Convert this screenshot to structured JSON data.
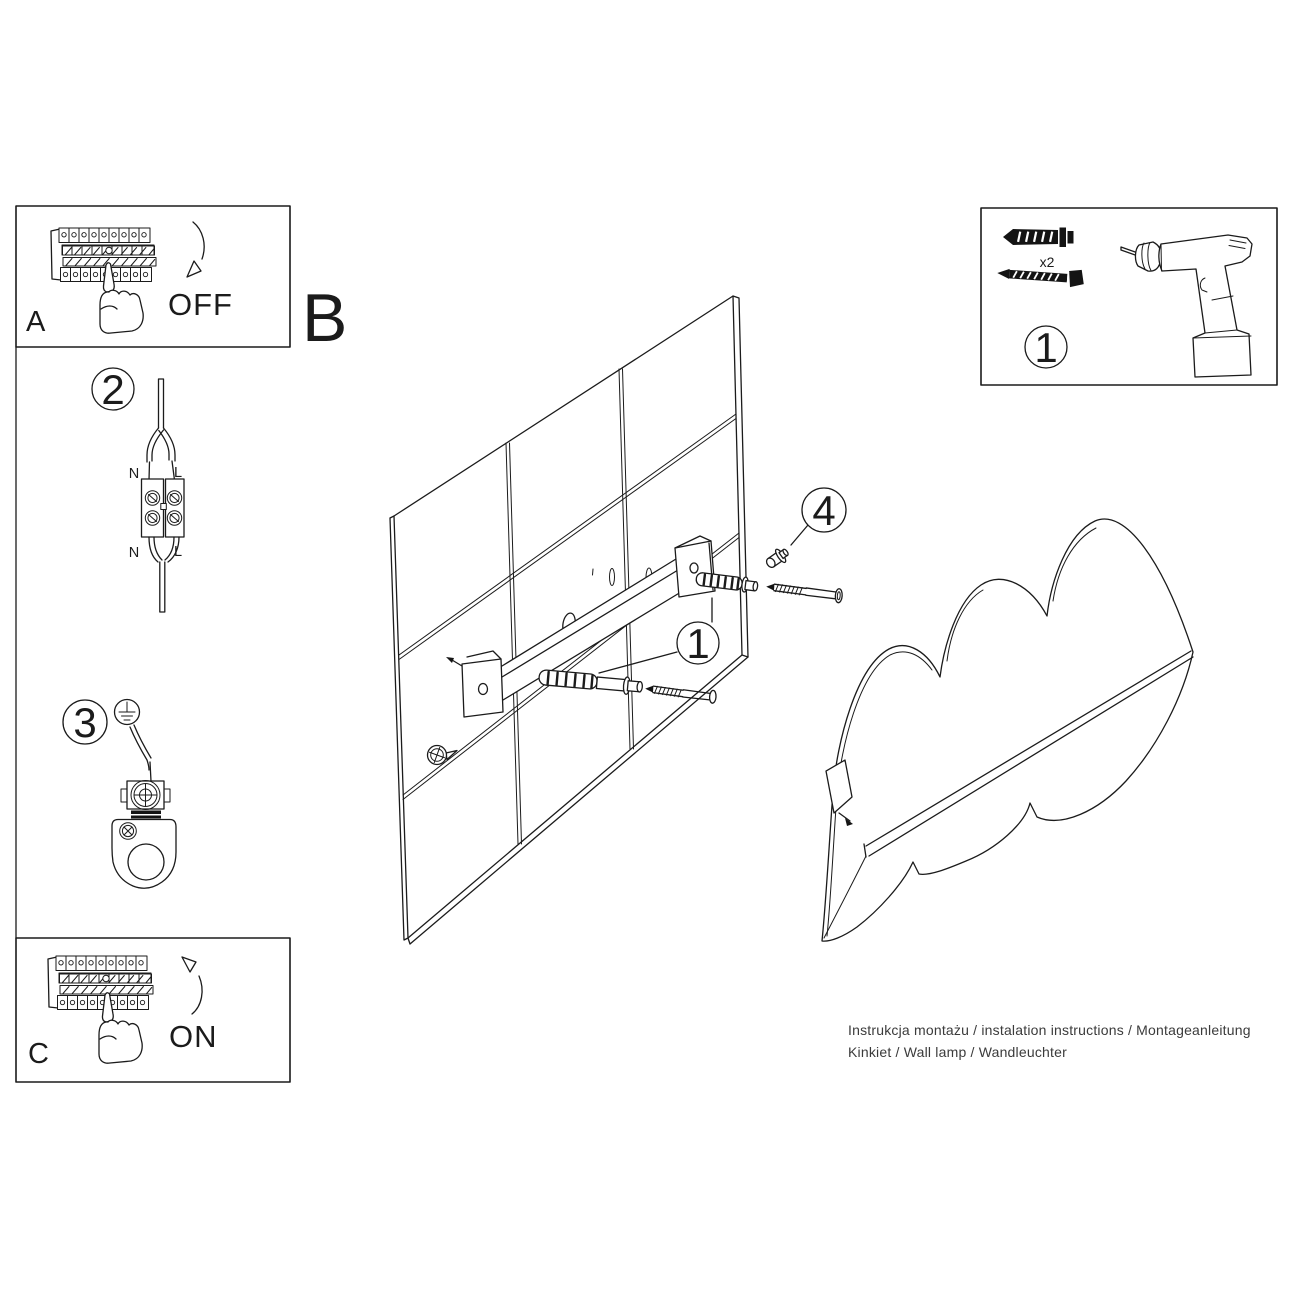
{
  "page": {
    "background": "#ffffff"
  },
  "colors": {
    "line": "#1b1b1b",
    "text": "#1b1b1b",
    "footer_text": "#3b3b3b"
  },
  "sections": {
    "panel_a": {
      "label": "A",
      "state": "OFF"
    },
    "panel_b": {
      "label": "B"
    },
    "panel_c": {
      "label": "C",
      "state": "ON"
    },
    "parts_box": {
      "marker": "1",
      "anchor_quantity": "x2"
    },
    "wire_step": {
      "marker": "2",
      "top_left": "N",
      "top_right": "L",
      "bottom_left": "N",
      "bottom_right": "L"
    },
    "ground_step": {
      "marker": "3"
    },
    "wall_step": {
      "marker": "1"
    },
    "cap_step": {
      "marker": "4"
    }
  },
  "footer": {
    "line1": "Instrukcja montażu / instalation instructions / Montageanleitung",
    "line2": "Kinkiet / Wall lamp / Wandleuchter"
  }
}
